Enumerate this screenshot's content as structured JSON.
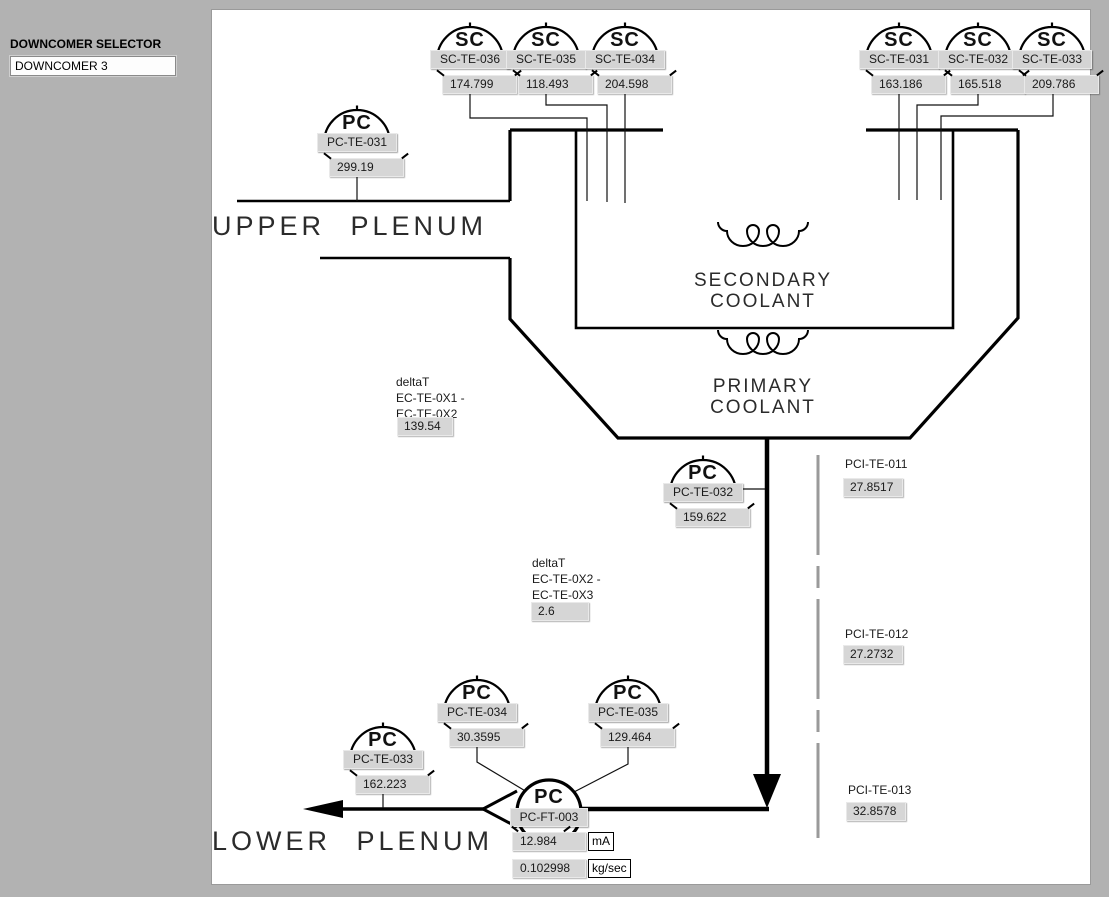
{
  "window": {
    "background": "#b2b2b2",
    "panel_background": "#ffffff"
  },
  "selector": {
    "label": "DOWNCOMER SELECTOR",
    "value": "DOWNCOMER 3"
  },
  "diagram": {
    "upper_plenum": "UPPER PLENUM",
    "lower_plenum": "LOWER PLENUM",
    "secondary_coolant": [
      "SECONDARY",
      "COOLANT"
    ],
    "primary_coolant": [
      "PRIMARY",
      "COOLANT"
    ]
  },
  "gauges": [
    {
      "id": "sc-te-036",
      "type": "SC",
      "tag": "SC-TE-036",
      "value": "174.799"
    },
    {
      "id": "sc-te-035",
      "type": "SC",
      "tag": "SC-TE-035",
      "value": "118.493"
    },
    {
      "id": "sc-te-034",
      "type": "SC",
      "tag": "SC-TE-034",
      "value": "204.598"
    },
    {
      "id": "sc-te-031",
      "type": "SC",
      "tag": "SC-TE-031",
      "value": "163.186"
    },
    {
      "id": "sc-te-032",
      "type": "SC",
      "tag": "SC-TE-032",
      "value": "165.518"
    },
    {
      "id": "sc-te-033",
      "type": "SC",
      "tag": "SC-TE-033",
      "value": "209.786"
    },
    {
      "id": "pc-te-031",
      "type": "PC",
      "tag": "PC-TE-031",
      "value": "299.19"
    },
    {
      "id": "pc-te-032",
      "type": "PC",
      "tag": "PC-TE-032",
      "value": "159.622"
    },
    {
      "id": "pc-te-034",
      "type": "PC",
      "tag": "PC-TE-034",
      "value": "30.3595"
    },
    {
      "id": "pc-te-035",
      "type": "PC",
      "tag": "PC-TE-035",
      "value": "129.464"
    },
    {
      "id": "pc-te-033",
      "type": "PC",
      "tag": "PC-TE-033",
      "value": "162.223"
    }
  ],
  "flow_transmitter": {
    "type": "PC",
    "tag": "PC-FT-003",
    "rows": [
      {
        "value": "12.984",
        "unit": "mA"
      },
      {
        "value": "0.102998",
        "unit": "kg/sec"
      }
    ]
  },
  "delta_t": [
    {
      "title": "deltaT",
      "expr_line1": "EC-TE-0X1 -",
      "expr_line2": "EC-TE-0X2",
      "value": "139.54"
    },
    {
      "title": "deltaT",
      "expr_line1": "EC-TE-0X2 -",
      "expr_line2": "EC-TE-0X3",
      "value": "2.6"
    }
  ],
  "pci_sensors": [
    {
      "tag": "PCI-TE-011",
      "value": "27.8517"
    },
    {
      "tag": "PCI-TE-012",
      "value": "27.2732"
    },
    {
      "tag": "PCI-TE-013",
      "value": "32.8578"
    }
  ],
  "colors": {
    "line": "#000000",
    "box_fill": "#d6d6d6",
    "pci_line": "#9a9a9a"
  }
}
